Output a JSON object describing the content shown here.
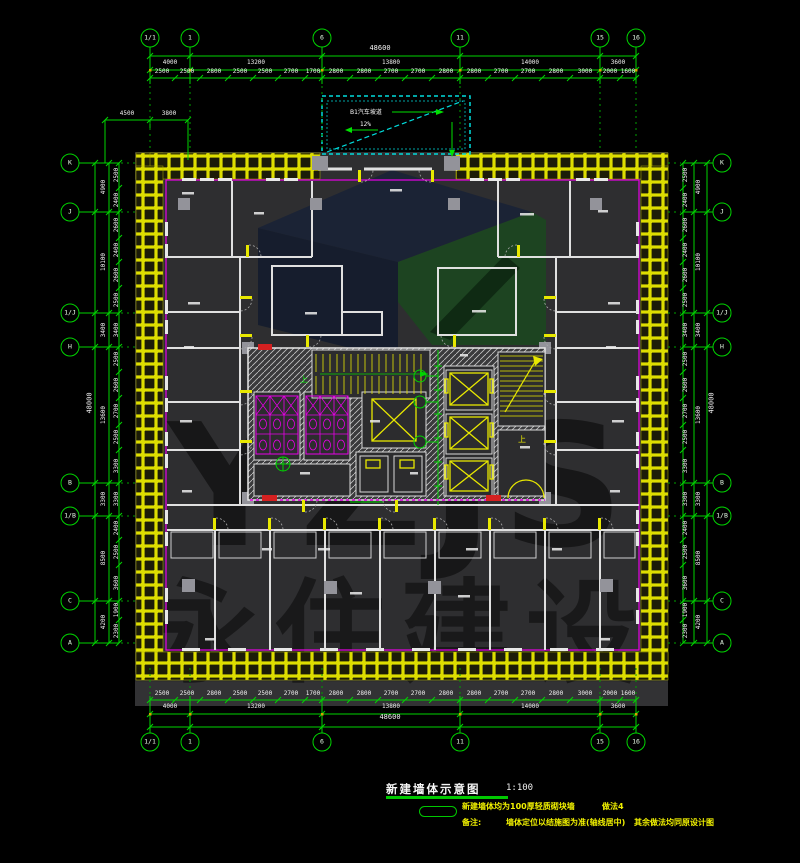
{
  "title_block": {
    "title": "新建墙体示意图",
    "scale": "1:100",
    "notes": {
      "n1a": "新建墙体均为100厚轻质砌块墙",
      "n1b": "做法4",
      "n2a": "备注:",
      "n2b": "墙体定位以结施图为准(轴线居中)",
      "n2c": "其余做法均同原设计图"
    }
  },
  "watermark": {
    "logo": "YZJS",
    "company": "永住建设"
  },
  "ramp": {
    "label": "B1汽车坡道",
    "slope": "12%"
  },
  "core": {
    "stair1_up": "上",
    "stair2_up": "上"
  },
  "colors": {
    "dim_green": "#00d400",
    "wall_yellow": "#e8e800",
    "boundary_magenta": "#e800e8",
    "ramp_cyan": "#00dcdc",
    "note_yellow": "#f0f000",
    "title_underline": "#00c800",
    "column_gray": "#93939a",
    "alarm_red": "#d42020"
  },
  "grid": {
    "top": [
      {
        "label": "1/1",
        "x": 150,
        "y": 38
      },
      {
        "label": "1",
        "x": 190,
        "y": 38
      },
      {
        "label": "6",
        "x": 322,
        "y": 38
      },
      {
        "label": "11",
        "x": 460,
        "y": 38
      },
      {
        "label": "15",
        "x": 600,
        "y": 38
      },
      {
        "label": "16",
        "x": 636,
        "y": 38
      }
    ],
    "bottom": [
      {
        "label": "1/1",
        "x": 150,
        "y": 742
      },
      {
        "label": "1",
        "x": 190,
        "y": 742
      },
      {
        "label": "6",
        "x": 322,
        "y": 742
      },
      {
        "label": "11",
        "x": 460,
        "y": 742
      },
      {
        "label": "15",
        "x": 600,
        "y": 742
      },
      {
        "label": "16",
        "x": 636,
        "y": 742
      }
    ],
    "left": [
      {
        "label": "K",
        "x": 70,
        "y": 163
      },
      {
        "label": "J",
        "x": 70,
        "y": 212
      },
      {
        "label": "1/J",
        "x": 70,
        "y": 313
      },
      {
        "label": "H",
        "x": 70,
        "y": 347
      },
      {
        "label": "B",
        "x": 70,
        "y": 483
      },
      {
        "label": "1/B",
        "x": 70,
        "y": 516
      },
      {
        "label": "C",
        "x": 70,
        "y": 601
      },
      {
        "label": "A",
        "x": 70,
        "y": 643
      }
    ],
    "right": [
      {
        "label": "K",
        "x": 722,
        "y": 163
      },
      {
        "label": "J",
        "x": 722,
        "y": 212
      },
      {
        "label": "1/J",
        "x": 722,
        "y": 313
      },
      {
        "label": "H",
        "x": 722,
        "y": 347
      },
      {
        "label": "B",
        "x": 722,
        "y": 483
      },
      {
        "label": "1/B",
        "x": 722,
        "y": 516
      },
      {
        "label": "C",
        "x": 722,
        "y": 601
      },
      {
        "label": "A",
        "x": 722,
        "y": 643
      }
    ]
  },
  "dims": {
    "top_overall": {
      "v": "48600",
      "x": 380,
      "y": 52
    },
    "bottom_overall": {
      "v": "48600",
      "x": 390,
      "y": 721
    },
    "left_overall": {
      "v": "48000",
      "x": 90,
      "y": 403
    },
    "right_overall": {
      "v": "48000",
      "x": 712,
      "y": 403
    },
    "corner_details": [
      {
        "v": "4500",
        "x": 127,
        "y": 117
      },
      {
        "v": "3800",
        "x": 169,
        "y": 117
      }
    ],
    "top_segments": [
      {
        "v": "4000",
        "x": 170,
        "y": 66
      },
      {
        "v": "13200",
        "x": 256,
        "y": 66
      },
      {
        "v": "13800",
        "x": 391,
        "y": 66
      },
      {
        "v": "14000",
        "x": 530,
        "y": 66
      },
      {
        "v": "3600",
        "x": 618,
        "y": 66
      }
    ],
    "top_details": [
      {
        "v": "2500",
        "x": 162,
        "y": 75
      },
      {
        "v": "2500",
        "x": 187,
        "y": 75
      },
      {
        "v": "2800",
        "x": 214,
        "y": 75
      },
      {
        "v": "2500",
        "x": 240,
        "y": 75
      },
      {
        "v": "2500",
        "x": 265,
        "y": 75
      },
      {
        "v": "2700",
        "x": 291,
        "y": 75
      },
      {
        "v": "1700",
        "x": 313,
        "y": 75
      },
      {
        "v": "2800",
        "x": 336,
        "y": 75
      },
      {
        "v": "2800",
        "x": 364,
        "y": 75
      },
      {
        "v": "2700",
        "x": 391,
        "y": 75
      },
      {
        "v": "2700",
        "x": 418,
        "y": 75
      },
      {
        "v": "2800",
        "x": 446,
        "y": 75
      },
      {
        "v": "2800",
        "x": 474,
        "y": 75
      },
      {
        "v": "2700",
        "x": 501,
        "y": 75
      },
      {
        "v": "2700",
        "x": 528,
        "y": 75
      },
      {
        "v": "2800",
        "x": 556,
        "y": 75
      },
      {
        "v": "3000",
        "x": 585,
        "y": 75
      },
      {
        "v": "2000",
        "x": 610,
        "y": 75
      },
      {
        "v": "1600",
        "x": 628,
        "y": 75
      }
    ],
    "bottom_segments": [
      {
        "v": "4000",
        "x": 170,
        "y": 710
      },
      {
        "v": "13200",
        "x": 256,
        "y": 710
      },
      {
        "v": "13800",
        "x": 391,
        "y": 710
      },
      {
        "v": "14000",
        "x": 530,
        "y": 710
      },
      {
        "v": "3600",
        "x": 618,
        "y": 710
      }
    ],
    "bottom_details": [
      {
        "v": "2500",
        "x": 162,
        "y": 697
      },
      {
        "v": "2500",
        "x": 187,
        "y": 697
      },
      {
        "v": "2800",
        "x": 214,
        "y": 697
      },
      {
        "v": "2500",
        "x": 240,
        "y": 697
      },
      {
        "v": "2500",
        "x": 265,
        "y": 697
      },
      {
        "v": "2700",
        "x": 291,
        "y": 697
      },
      {
        "v": "1700",
        "x": 313,
        "y": 697
      },
      {
        "v": "2800",
        "x": 336,
        "y": 697
      },
      {
        "v": "2800",
        "x": 364,
        "y": 697
      },
      {
        "v": "2700",
        "x": 391,
        "y": 697
      },
      {
        "v": "2700",
        "x": 418,
        "y": 697
      },
      {
        "v": "2800",
        "x": 446,
        "y": 697
      },
      {
        "v": "2800",
        "x": 474,
        "y": 697
      },
      {
        "v": "2700",
        "x": 501,
        "y": 697
      },
      {
        "v": "2700",
        "x": 528,
        "y": 697
      },
      {
        "v": "2800",
        "x": 556,
        "y": 697
      },
      {
        "v": "3000",
        "x": 585,
        "y": 697
      },
      {
        "v": "2000",
        "x": 610,
        "y": 697
      },
      {
        "v": "1600",
        "x": 628,
        "y": 697
      }
    ],
    "left_segments": [
      {
        "v": "4900",
        "x": 104,
        "y": 187
      },
      {
        "v": "10100",
        "x": 104,
        "y": 262
      },
      {
        "v": "3400",
        "x": 104,
        "y": 330
      },
      {
        "v": "13600",
        "x": 104,
        "y": 415
      },
      {
        "v": "3300",
        "x": 104,
        "y": 499
      },
      {
        "v": "8500",
        "x": 104,
        "y": 558
      },
      {
        "v": "4200",
        "x": 104,
        "y": 622
      }
    ],
    "left_details": [
      {
        "v": "2500",
        "x": 117,
        "y": 175
      },
      {
        "v": "2400",
        "x": 117,
        "y": 200
      },
      {
        "v": "2600",
        "x": 117,
        "y": 225
      },
      {
        "v": "2400",
        "x": 117,
        "y": 250
      },
      {
        "v": "2600",
        "x": 117,
        "y": 275
      },
      {
        "v": "2500",
        "x": 117,
        "y": 300
      },
      {
        "v": "3400",
        "x": 117,
        "y": 330
      },
      {
        "v": "2500",
        "x": 117,
        "y": 359
      },
      {
        "v": "2600",
        "x": 117,
        "y": 385
      },
      {
        "v": "2700",
        "x": 117,
        "y": 411
      },
      {
        "v": "2500",
        "x": 117,
        "y": 437
      },
      {
        "v": "3300",
        "x": 117,
        "y": 466
      },
      {
        "v": "3300",
        "x": 117,
        "y": 499
      },
      {
        "v": "2400",
        "x": 117,
        "y": 528
      },
      {
        "v": "2500",
        "x": 117,
        "y": 552
      },
      {
        "v": "3600",
        "x": 117,
        "y": 583
      },
      {
        "v": "1900",
        "x": 117,
        "y": 610
      },
      {
        "v": "2300",
        "x": 117,
        "y": 631
      }
    ],
    "right_segments": [
      {
        "v": "4900",
        "x": 699,
        "y": 187
      },
      {
        "v": "10100",
        "x": 699,
        "y": 262
      },
      {
        "v": "3400",
        "x": 699,
        "y": 330
      },
      {
        "v": "13600",
        "x": 699,
        "y": 415
      },
      {
        "v": "3300",
        "x": 699,
        "y": 499
      },
      {
        "v": "8500",
        "x": 699,
        "y": 558
      },
      {
        "v": "4200",
        "x": 699,
        "y": 622
      }
    ],
    "right_details": [
      {
        "v": "2500",
        "x": 686,
        "y": 175
      },
      {
        "v": "2400",
        "x": 686,
        "y": 200
      },
      {
        "v": "2600",
        "x": 686,
        "y": 225
      },
      {
        "v": "2400",
        "x": 686,
        "y": 250
      },
      {
        "v": "2600",
        "x": 686,
        "y": 275
      },
      {
        "v": "2500",
        "x": 686,
        "y": 300
      },
      {
        "v": "3400",
        "x": 686,
        "y": 330
      },
      {
        "v": "2500",
        "x": 686,
        "y": 359
      },
      {
        "v": "2600",
        "x": 686,
        "y": 385
      },
      {
        "v": "2700",
        "x": 686,
        "y": 411
      },
      {
        "v": "2500",
        "x": 686,
        "y": 437
      },
      {
        "v": "3300",
        "x": 686,
        "y": 466
      },
      {
        "v": "3300",
        "x": 686,
        "y": 499
      },
      {
        "v": "2400",
        "x": 686,
        "y": 528
      },
      {
        "v": "2500",
        "x": 686,
        "y": 552
      },
      {
        "v": "3600",
        "x": 686,
        "y": 583
      },
      {
        "v": "1900",
        "x": 686,
        "y": 610
      },
      {
        "v": "2300",
        "x": 686,
        "y": 631
      }
    ]
  }
}
